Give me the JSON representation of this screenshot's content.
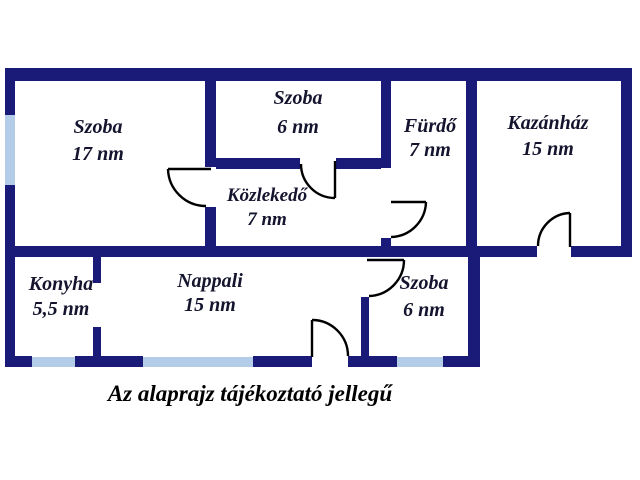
{
  "caption": "Az alaprajz tájékoztató jellegű",
  "rooms": {
    "szoba17": {
      "name": "Szoba",
      "area": "17 nm"
    },
    "szoba6_top": {
      "name": "Szoba",
      "area": "6 nm"
    },
    "furdo": {
      "name": "Fürdő",
      "area": "7 nm"
    },
    "kazanhaz": {
      "name": "Kazánház",
      "area": "15 nm"
    },
    "kozlekedo": {
      "name": "Közlekedő",
      "area": "7 nm"
    },
    "konyha": {
      "name": "Konyha",
      "area": "5,5 nm"
    },
    "nappali": {
      "name": "Nappali",
      "area": "15 nm"
    },
    "szoba6_bottom": {
      "name": "Szoba",
      "area": "6 nm"
    }
  },
  "colors": {
    "wall": "#1a1a78",
    "window": "#b3cde8",
    "door": "#000000",
    "text": "#14142e",
    "background": "#ffffff"
  }
}
